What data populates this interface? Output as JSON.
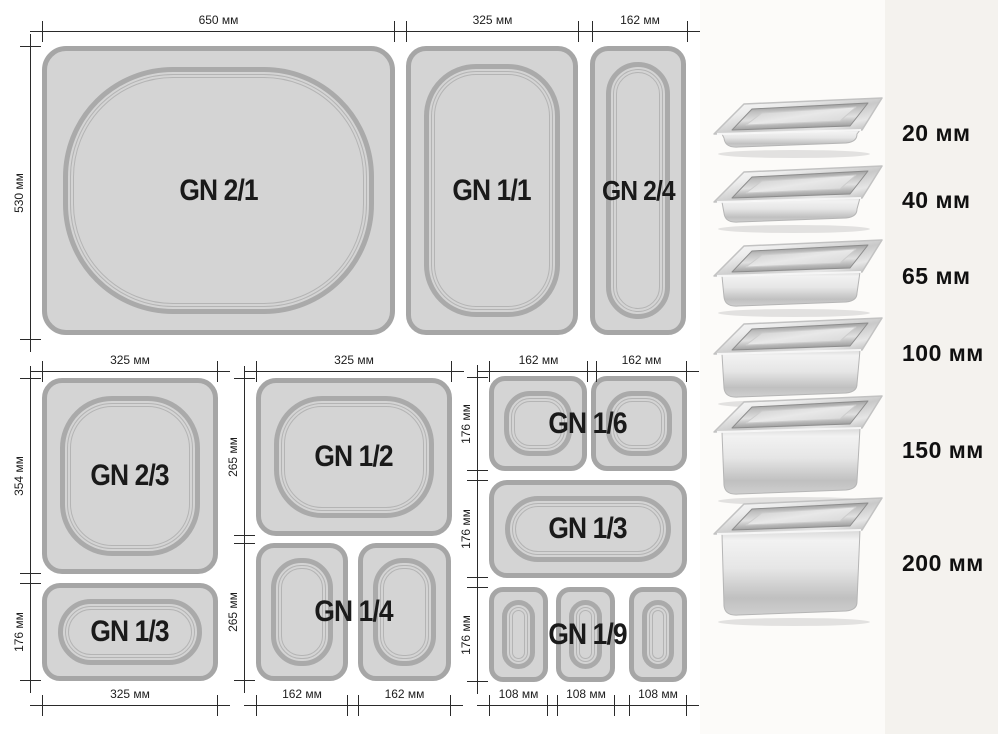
{
  "trays": {
    "gn21": "GN 2/1",
    "gn11": "GN 1/1",
    "gn24": "GN 2/4",
    "gn23": "GN 2/3",
    "gn13": "GN 1/3",
    "gn12": "GN 1/2",
    "gn14": "GN 1/4",
    "gn16": "GN 1/6",
    "gn19": "GN 1/9"
  },
  "dims": {
    "w650": "650 мм",
    "w325": "325 мм",
    "w162": "162 мм",
    "w108": "108 мм",
    "h530": "530 мм",
    "h354": "354 мм",
    "h265": "265 мм",
    "h176": "176 мм"
  },
  "pans": [
    {
      "label": "20 мм",
      "depth_mm": 20
    },
    {
      "label": "40 мм",
      "depth_mm": 40
    },
    {
      "label": "65 мм",
      "depth_mm": 65
    },
    {
      "label": "100 мм",
      "depth_mm": 100
    },
    {
      "label": "150 мм",
      "depth_mm": 150
    },
    {
      "label": "200 мм",
      "depth_mm": 200
    }
  ],
  "colors": {
    "tray_fill": "#d4d4d4",
    "tray_border": "#a6a6a6",
    "dim_line": "#2a2a2a",
    "label_text": "#1a1a1a",
    "panel_bg": "#f4f2ee"
  }
}
